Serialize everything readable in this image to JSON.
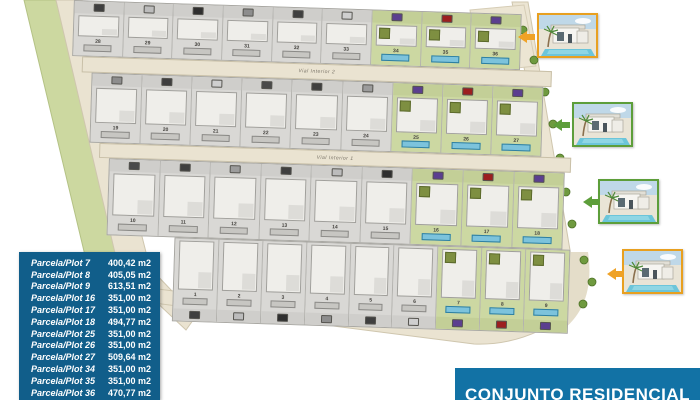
{
  "banner": {
    "text": "CONJUNTO RESIDENCIAL",
    "bg_color": "#1272a5"
  },
  "plots_table": {
    "bg_color": "#115e8a",
    "rows": [
      {
        "label": "Parcela/Plot 7",
        "area": "400,42 m2"
      },
      {
        "label": "Parcela/Plot 8",
        "area": "405,05 m2"
      },
      {
        "label": "Parcela/Plot 9",
        "area": "613,51 m2"
      },
      {
        "label": "Parcela/Plot 16",
        "area": "351,00 m2"
      },
      {
        "label": "Parcela/Plot 17",
        "area": "351,00 m2"
      },
      {
        "label": "Parcela/Plot 18",
        "area": "494,77 m2"
      },
      {
        "label": "Parcela/Plot 25",
        "area": "351,00 m2"
      },
      {
        "label": "Parcela/Plot 26",
        "area": "351,00 m2"
      },
      {
        "label": "Parcela/Plot 27",
        "area": "509,64 m2"
      },
      {
        "label": "Parcela/Plot 34",
        "area": "351,00 m2"
      },
      {
        "label": "Parcela/Plot 35",
        "area": "351,00 m2"
      },
      {
        "label": "Parcela/Plot 36",
        "area": "470,77 m2"
      }
    ]
  },
  "site_plan": {
    "road_labels": [
      "Vial Interior 2",
      "Vial Interior 1"
    ],
    "rows": [
      {
        "plots": [
          28,
          29,
          30,
          31,
          32,
          33,
          34,
          35,
          36
        ],
        "road_after": "Vial Interior 2",
        "entry": "top"
      },
      {
        "plots": [
          19,
          20,
          21,
          22,
          23,
          24,
          25,
          26,
          27
        ],
        "road_after": "Vial Interior 1",
        "entry": "top"
      },
      {
        "plots": [
          10,
          11,
          12,
          13,
          14,
          15,
          16,
          17,
          18
        ],
        "road_after": null,
        "entry": "top"
      },
      {
        "plots": [
          1,
          2,
          3,
          4,
          5,
          6,
          7,
          8,
          9
        ],
        "road_after": null,
        "entry": "bottom"
      }
    ],
    "highlighted_plots": [
      7,
      8,
      9,
      16,
      17,
      18,
      25,
      26,
      27,
      34,
      35,
      36
    ],
    "colors": {
      "lawn_green": "#ccd8a2",
      "pool_blue": "#7cc3dc",
      "plot_gray": "#d9d8d5",
      "road_beige": "#eae3d1",
      "band_green": "#ccd8a0",
      "pergola_purple": "#5b3f8f",
      "car_red": "#9c1f1f"
    }
  },
  "thumbnails": [
    {
      "name": "villa-render-thumbnail-1",
      "border_color": "#e8a020",
      "arrow_color": "#efa226"
    },
    {
      "name": "villa-render-thumbnail-2",
      "border_color": "#5d9e3a",
      "arrow_color": "#5d9e3a"
    },
    {
      "name": "villa-render-thumbnail-3",
      "border_color": "#5d9e3a",
      "arrow_color": "#5d9e3a"
    },
    {
      "name": "villa-render-thumbnail-4",
      "border_color": "#e8a020",
      "arrow_color": "#efa226"
    }
  ]
}
